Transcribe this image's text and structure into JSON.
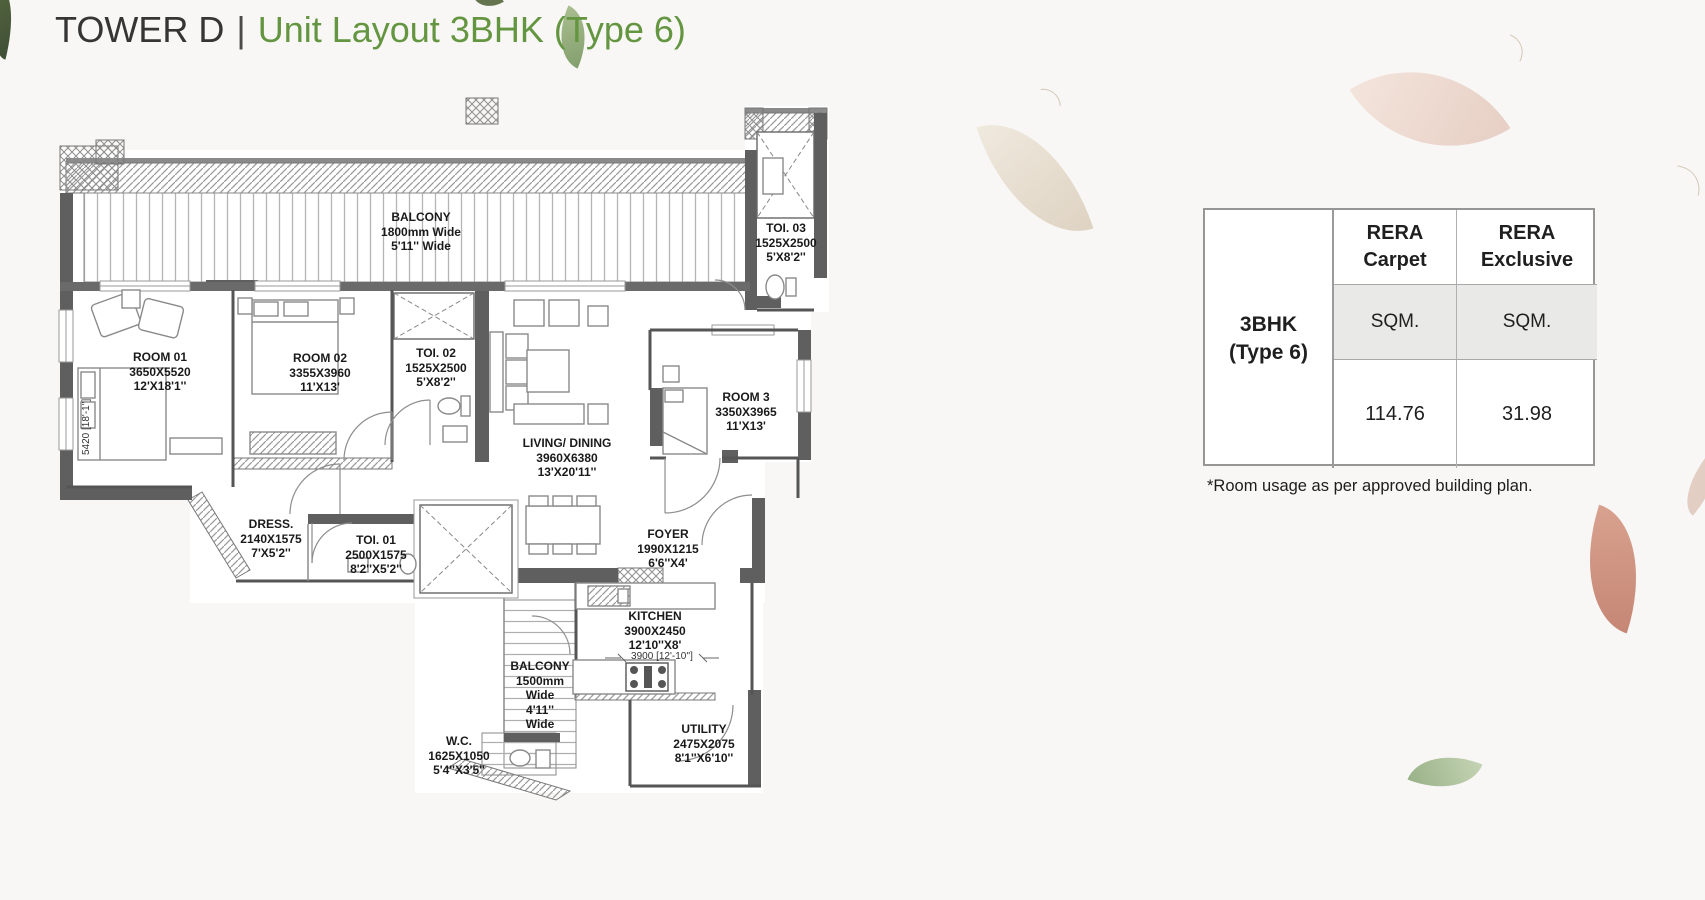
{
  "title": {
    "tower": "TOWER D",
    "separator": "|",
    "unit": "Unit Layout 3BHK (Type 6)"
  },
  "colors": {
    "title_accent": "#649540",
    "wall_gray": "#5f5f5f",
    "table_band": "#e9e9e7"
  },
  "table": {
    "row_label": [
      "3BHK",
      "(Type 6)"
    ],
    "columns": [
      {
        "header": [
          "RERA",
          "Carpet"
        ],
        "unit": "SQM.",
        "value": "114.76"
      },
      {
        "header": [
          "RERA",
          "Exclusive"
        ],
        "unit": "SQM.",
        "value": "31.98"
      }
    ]
  },
  "footnote": "*Room usage as per approved building plan.",
  "floorplan": {
    "rooms": [
      {
        "id": "balcony-top",
        "lines": [
          "BALCONY",
          "1800mm Wide",
          "5'11'' Wide"
        ]
      },
      {
        "id": "toi-03",
        "lines": [
          "TOI. 03",
          "1525X2500",
          "5'X8'2''"
        ]
      },
      {
        "id": "room-01",
        "lines": [
          "ROOM 01",
          "3650X5520",
          "12'X18'1''"
        ]
      },
      {
        "id": "room-02",
        "lines": [
          "ROOM 02",
          "3355X3960",
          "11'X13'"
        ]
      },
      {
        "id": "toi-02",
        "lines": [
          "TOI. 02",
          "1525X2500",
          "5'X8'2''"
        ]
      },
      {
        "id": "living-dining",
        "lines": [
          "LIVING/ DINING",
          "3960X6380",
          "13'X20'11''"
        ]
      },
      {
        "id": "room-3",
        "lines": [
          "ROOM 3",
          "3350X3965",
          "11'X13'"
        ]
      },
      {
        "id": "dress",
        "lines": [
          "DRESS.",
          "2140X1575",
          "7'X5'2''"
        ]
      },
      {
        "id": "toi-01",
        "lines": [
          "TOI. 01",
          "2500X1575",
          "8'2''X5'2''"
        ]
      },
      {
        "id": "foyer",
        "lines": [
          "FOYER",
          "1990X1215",
          "6'6''X4'"
        ]
      },
      {
        "id": "kitchen",
        "lines": [
          "KITCHEN",
          "3900X2450",
          "12'10''X8'"
        ]
      },
      {
        "id": "kitchen-dim",
        "lines": [
          "3900 [12'-10'']"
        ]
      },
      {
        "id": "balcony-bottom",
        "lines": [
          "BALCONY",
          "1500mm",
          "Wide",
          "4'11''",
          "Wide"
        ]
      },
      {
        "id": "wc",
        "lines": [
          "W.C.",
          "1625X1050",
          "5'4''X3'5''"
        ]
      },
      {
        "id": "utility",
        "lines": [
          "UTILITY",
          "2475X2075",
          "8'1''X6'10''"
        ]
      },
      {
        "id": "room01-dim",
        "lines": [
          "5420 [18'-1'']"
        ]
      }
    ]
  }
}
